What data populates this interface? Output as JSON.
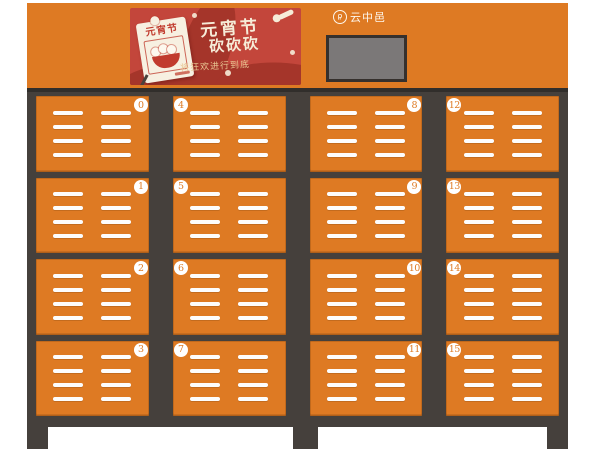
{
  "brand": {
    "name": "云中邑",
    "icon": "brand-seal-icon"
  },
  "banner": {
    "calendar_label": "元宵节",
    "title_line1": "元宵节",
    "title_line2": "砍砍砍",
    "subtitle": "将狂欢进行到底"
  },
  "colors": {
    "door_orange": "#de7a23",
    "frame_dark": "#45403c",
    "banner_red": "#c3463b",
    "wave_red": "#a5352a",
    "cream_text": "#f6ecd8",
    "gold_text": "#e9c793",
    "card_cream": "#f7f0e1",
    "bowl_red": "#c13b2e",
    "screen_gray": "#7b7878"
  },
  "cabinet": {
    "vent_columns": 2,
    "vent_lines_per_column": 4,
    "columns": [
      {
        "badge_side": "right",
        "lockers": [
          "0",
          "1",
          "2",
          "3"
        ]
      },
      {
        "badge_side": "left",
        "lockers": [
          "4",
          "5",
          "6",
          "7"
        ]
      },
      {
        "badge_side": "right",
        "lockers": [
          "8",
          "9",
          "10",
          "11"
        ]
      },
      {
        "badge_side": "left",
        "lockers": [
          "12",
          "13",
          "14",
          "15"
        ]
      }
    ]
  }
}
